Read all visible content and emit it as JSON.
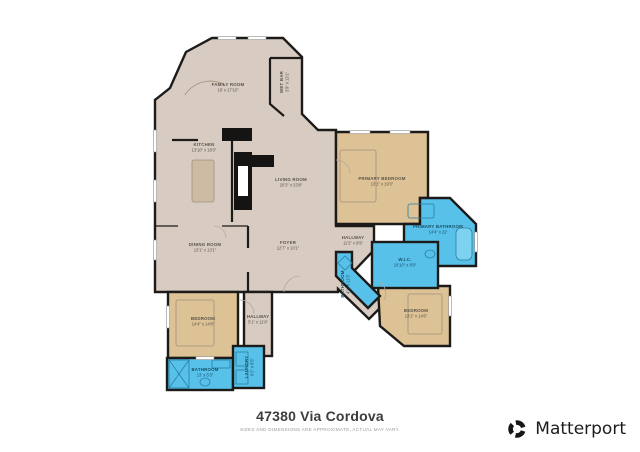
{
  "title": {
    "address": "47380 Via Cordova",
    "disclaimer": "SIZES AND DIMENSIONS ARE APPROXIMATE, ACTUAL MAY VARY."
  },
  "brand": {
    "name": "Matterport"
  },
  "palette": {
    "floor_main": "#d8ccc2",
    "floor_bedroom": "#dcc295",
    "floor_bath": "#58c1e9",
    "wall": "#1d1b19",
    "background": "#ffffff"
  },
  "rooms": [
    {
      "id": "family-room",
      "name": "FAMILY ROOM",
      "dims": "18' x 17'10\"",
      "x": 228,
      "y": 86,
      "rotate": 0,
      "zone": "main"
    },
    {
      "id": "wet-bar",
      "name": "WET BAR",
      "dims": "3'9\" x 13'1\"",
      "x": 283,
      "y": 82,
      "rotate": -90,
      "zone": "main"
    },
    {
      "id": "kitchen",
      "name": "KITCHEN",
      "dims": "13'10\" x 18'3\"",
      "x": 204,
      "y": 146,
      "rotate": 0,
      "zone": "main"
    },
    {
      "id": "living-room",
      "name": "LIVING ROOM",
      "dims": "20'3\" x 23'8\"",
      "x": 291,
      "y": 181,
      "rotate": 0,
      "zone": "main"
    },
    {
      "id": "primary-bedroom",
      "name": "PRIMARY BEDROOM",
      "dims": "13'1\" x 19'3\"",
      "x": 382,
      "y": 180,
      "rotate": 0,
      "zone": "bed"
    },
    {
      "id": "primary-bathroom",
      "name": "PRIMARY BATHROOM",
      "dims": "14'4\" x 22'",
      "x": 438,
      "y": 228,
      "rotate": 0,
      "zone": "wet"
    },
    {
      "id": "dining-room",
      "name": "DINING ROOM",
      "dims": "13'1\" x 13'1\"",
      "x": 205,
      "y": 246,
      "rotate": 0,
      "zone": "main"
    },
    {
      "id": "foyer",
      "name": "FOYER",
      "dims": "12'7\" x 10'1\"",
      "x": 288,
      "y": 244,
      "rotate": 0,
      "zone": "main"
    },
    {
      "id": "hallway-upper",
      "name": "HALLWAY",
      "dims": "11'2\" x 9'9\"",
      "x": 353,
      "y": 239,
      "rotate": 0,
      "zone": "main"
    },
    {
      "id": "wic",
      "name": "W.I.C.",
      "dims": "10'10\" x 8'9\"",
      "x": 405,
      "y": 261,
      "rotate": 0,
      "zone": "wet"
    },
    {
      "id": "hall-bathroom",
      "name": "BATHROOM",
      "dims": "4'2\" x 11'3\"",
      "x": 344,
      "y": 284,
      "rotate": -90,
      "zone": "wet"
    },
    {
      "id": "bedroom-west",
      "name": "BEDROOM",
      "dims": "14'4\" x 14'8\"",
      "x": 203,
      "y": 320,
      "rotate": 0,
      "zone": "bed"
    },
    {
      "id": "hallway-lower",
      "name": "HALLWAY",
      "dims": "5'1\" x 11'9\"",
      "x": 258,
      "y": 318,
      "rotate": 0,
      "zone": "main"
    },
    {
      "id": "bedroom-east",
      "name": "BEDROOM",
      "dims": "13'1\" x 14'6\"",
      "x": 416,
      "y": 312,
      "rotate": 0,
      "zone": "bed"
    },
    {
      "id": "bathroom-west",
      "name": "BATHROOM",
      "dims": "13' x 5'3\"",
      "x": 205,
      "y": 371,
      "rotate": 0,
      "zone": "wet"
    },
    {
      "id": "laundry",
      "name": "LAUNDRY",
      "dims": "6'2\" x 8'5\"",
      "x": 248,
      "y": 367,
      "rotate": -90,
      "zone": "wet"
    }
  ]
}
